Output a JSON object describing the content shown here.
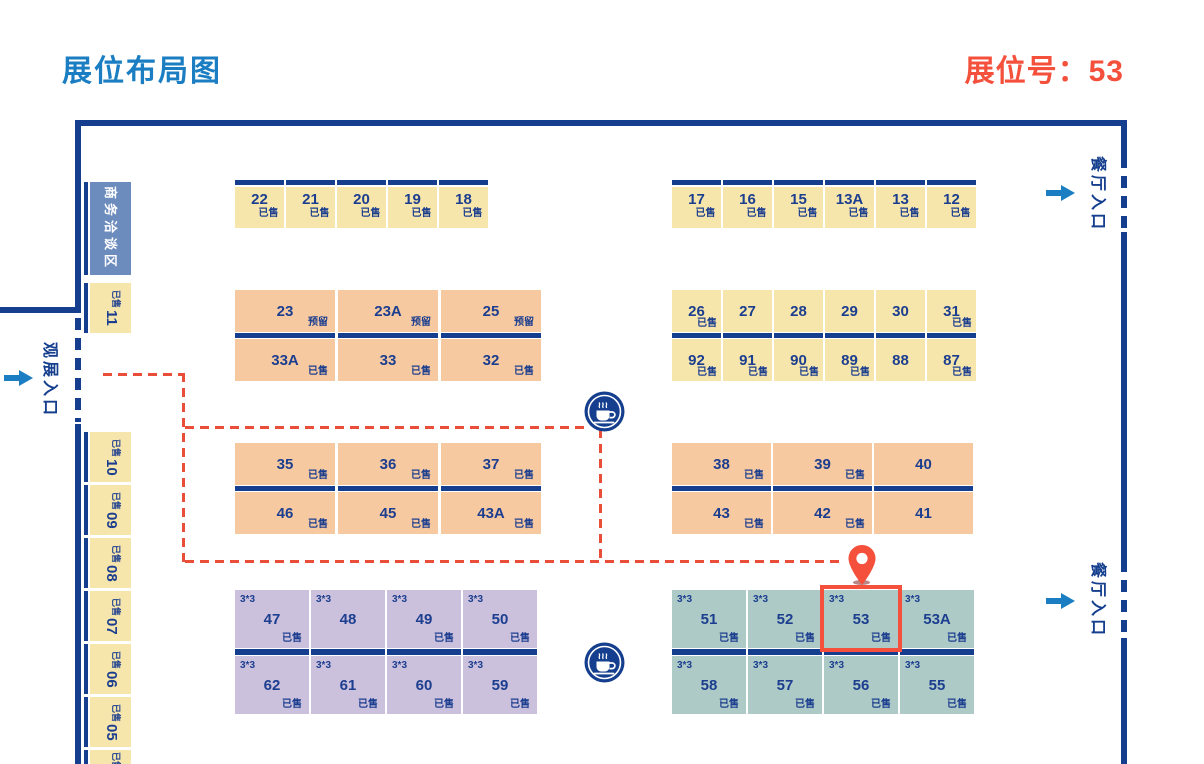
{
  "header": {
    "title": "展位布局图",
    "selected_booth": "展位号：53",
    "selected_booth_no": "53"
  },
  "labels": {
    "negotiation_area": "商务洽谈区",
    "visitor_entrance": "观展入口",
    "restaurant_entrance": "餐厅入口",
    "size": "3*3",
    "sold": "已售",
    "reserved": "预留"
  },
  "colors": {
    "title_blue": "#1B7EC2",
    "accent_red": "#F4503C",
    "wall_navy": "#153F8E",
    "booth_text_navy": "#1C3E8F",
    "route_red": "#E94E38",
    "booth_yellow": "#F7E6AC",
    "booth_orange": "#F7C9A0",
    "booth_purple": "#CCC1DD",
    "booth_teal": "#AECAC7",
    "negotiation_blue": "#6D8CBE"
  },
  "icons": {
    "coffee": "coffee-cup-icon",
    "pin": "location-pin-icon",
    "arrow": "arrow-right-icon"
  },
  "side": {
    "booths": [
      {
        "id": "11",
        "status": "已售"
      },
      {
        "id": "10",
        "status": "已售"
      },
      {
        "id": "09",
        "status": "已售"
      },
      {
        "id": "08",
        "status": "已售"
      },
      {
        "id": "07",
        "status": "已售"
      },
      {
        "id": "06",
        "status": "已售"
      },
      {
        "id": "05",
        "status": "已售"
      },
      {
        "id": "A",
        "status": "已售"
      }
    ]
  },
  "blocks": {
    "top_left": [
      {
        "id": "22",
        "status": "已售"
      },
      {
        "id": "21",
        "status": "已售"
      },
      {
        "id": "20",
        "status": "已售"
      },
      {
        "id": "19",
        "status": "已售"
      },
      {
        "id": "18",
        "status": "已售"
      }
    ],
    "top_right": [
      {
        "id": "17",
        "status": "已售"
      },
      {
        "id": "16",
        "status": "已售"
      },
      {
        "id": "15",
        "status": "已售"
      },
      {
        "id": "13A",
        "status": "已售"
      },
      {
        "id": "13",
        "status": "已售"
      },
      {
        "id": "12",
        "status": "已售"
      }
    ],
    "mid_left": {
      "rows": [
        [
          {
            "id": "23",
            "status": "预留"
          },
          {
            "id": "23A",
            "status": "预留"
          },
          {
            "id": "25",
            "status": "预留"
          }
        ],
        [
          {
            "id": "33A",
            "status": "已售"
          },
          {
            "id": "33",
            "status": "已售"
          },
          {
            "id": "32",
            "status": "已售"
          }
        ]
      ]
    },
    "mid_right": {
      "rows": [
        [
          {
            "id": "26",
            "status": "已售"
          },
          {
            "id": "27",
            "status": ""
          },
          {
            "id": "28",
            "status": ""
          },
          {
            "id": "29",
            "status": ""
          },
          {
            "id": "30",
            "status": ""
          },
          {
            "id": "31",
            "status": "已售"
          }
        ],
        [
          {
            "id": "92",
            "status": "已售"
          },
          {
            "id": "91",
            "status": "已售"
          },
          {
            "id": "90",
            "status": "已售"
          },
          {
            "id": "89",
            "status": "已售"
          },
          {
            "id": "88",
            "status": ""
          },
          {
            "id": "87",
            "status": "已售"
          }
        ]
      ]
    },
    "lower_left": {
      "rows": [
        [
          {
            "id": "35",
            "status": "已售"
          },
          {
            "id": "36",
            "status": "已售"
          },
          {
            "id": "37",
            "status": "已售"
          }
        ],
        [
          {
            "id": "46",
            "status": "已售"
          },
          {
            "id": "45",
            "status": "已售"
          },
          {
            "id": "43A",
            "status": "已售"
          }
        ]
      ]
    },
    "lower_right": {
      "rows": [
        [
          {
            "id": "38",
            "status": "已售"
          },
          {
            "id": "39",
            "status": "已售"
          },
          {
            "id": "40",
            "status": ""
          }
        ],
        [
          {
            "id": "43",
            "status": "已售"
          },
          {
            "id": "42",
            "status": "已售"
          },
          {
            "id": "41",
            "status": ""
          }
        ]
      ]
    },
    "bottom_left": {
      "rows": [
        [
          {
            "id": "47",
            "status": "已售"
          },
          {
            "id": "48",
            "status": ""
          },
          {
            "id": "49",
            "status": "已售"
          },
          {
            "id": "50",
            "status": "已售"
          }
        ],
        [
          {
            "id": "62",
            "status": "已售"
          },
          {
            "id": "61",
            "status": "已售"
          },
          {
            "id": "60",
            "status": "已售"
          },
          {
            "id": "59",
            "status": "已售"
          }
        ]
      ]
    },
    "bottom_right": {
      "rows": [
        [
          {
            "id": "51",
            "status": "已售"
          },
          {
            "id": "52",
            "status": "已售"
          },
          {
            "id": "53",
            "status": "已售"
          },
          {
            "id": "53A",
            "status": "已售"
          }
        ],
        [
          {
            "id": "58",
            "status": "已售"
          },
          {
            "id": "57",
            "status": "已售"
          },
          {
            "id": "56",
            "status": "已售"
          },
          {
            "id": "55",
            "status": "已售"
          }
        ]
      ]
    }
  }
}
